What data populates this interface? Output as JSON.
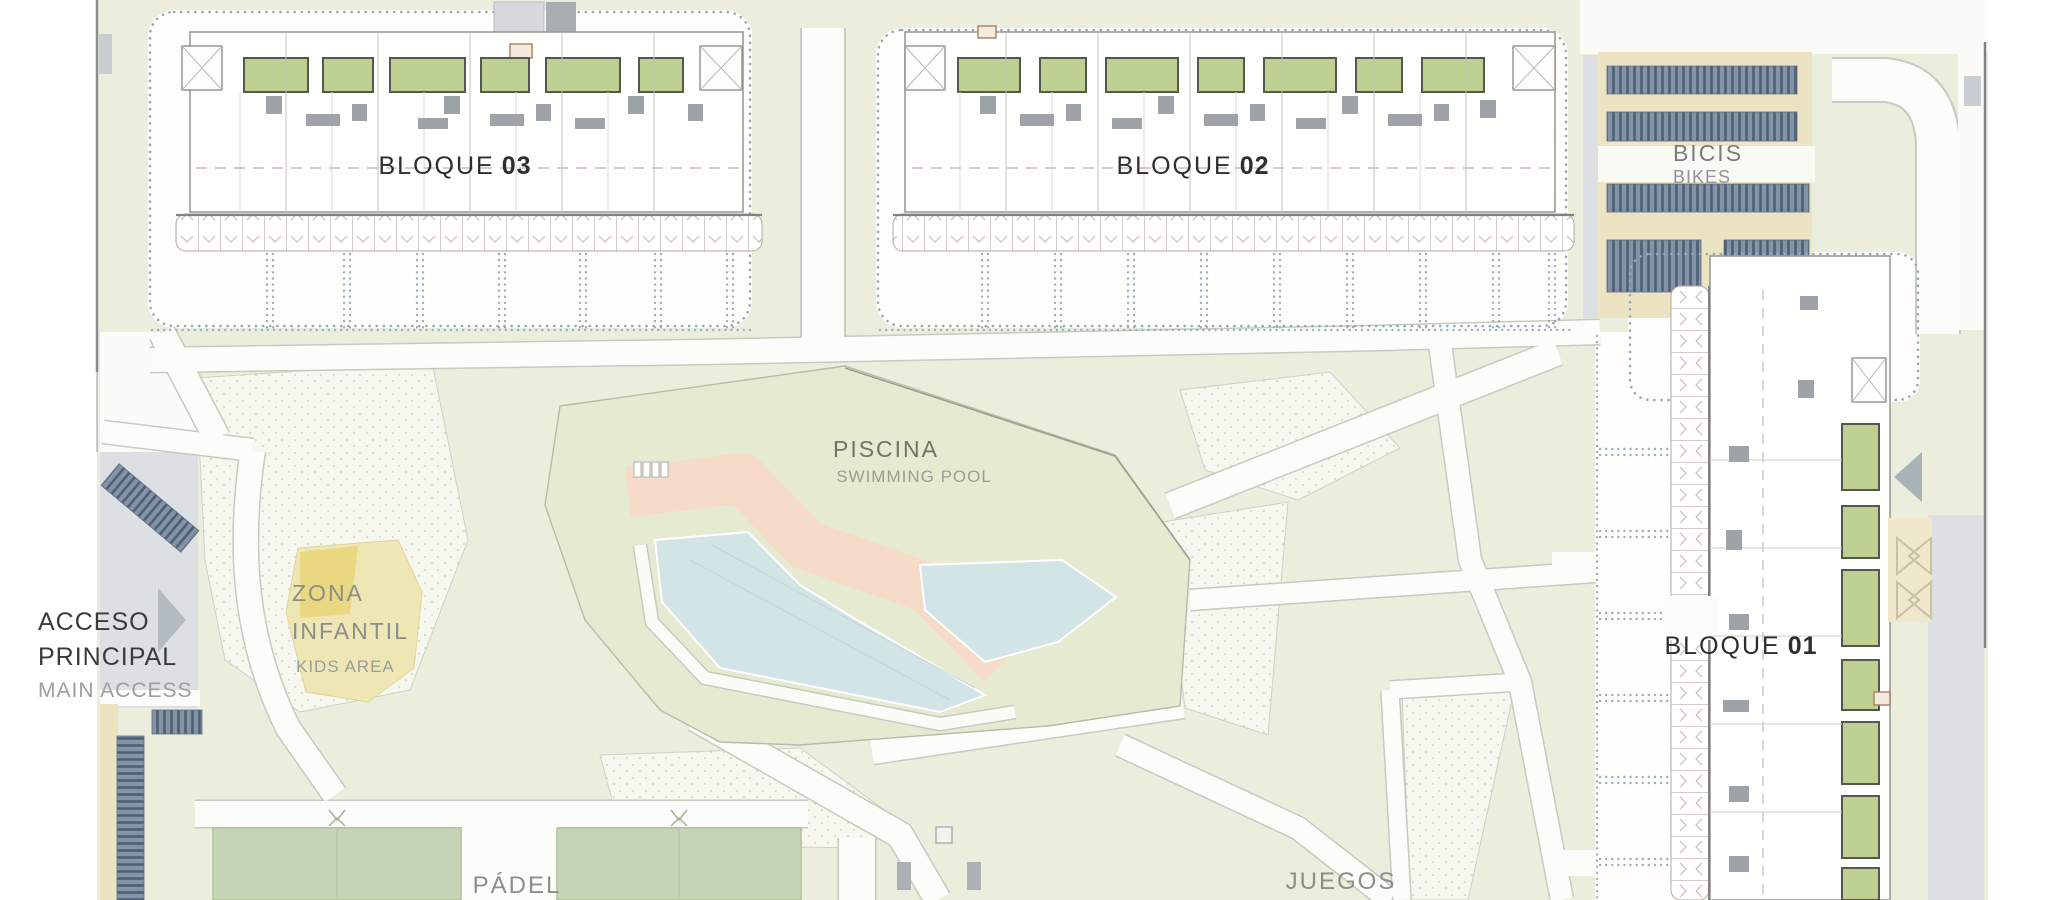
{
  "document": {
    "type": "residential-masterplan-site-plan"
  },
  "labels": {
    "bloque03": {
      "name": "BLOQUE",
      "number": "03"
    },
    "bloque02": {
      "name": "BLOQUE",
      "number": "02"
    },
    "bloque01": {
      "name": "BLOQUE",
      "number": "01"
    },
    "bikes": {
      "es": "BICIS",
      "en": "BIKES"
    },
    "pool": {
      "es": "PISCINA",
      "en": "SWIMMING POOL"
    },
    "kids": {
      "es_line1": "ZONA",
      "es_line2": "INFANTIL",
      "en": "KIDS AREA"
    },
    "access": {
      "es_line1": "ACCESO",
      "es_line2": "PRINCIPAL",
      "en": "MAIN ACCESS"
    },
    "padel": {
      "es": "PÁDEL"
    },
    "games": {
      "es": "JUEGOS"
    }
  },
  "colors": {
    "site_green": "#ebeedc",
    "pool_platform_green": "#e6ead0",
    "path_white": "#fcfdfa",
    "path_edge": "#c6cac0",
    "pool_water": "#d3e4e6",
    "pool_deck_salmon": "#f5dbc8",
    "padel_court_green": "#c6d5b4",
    "patio_green": "#bdd092",
    "kids_yellow": "#efe6b6",
    "kids_yellow_bright": "#e8d67a",
    "bike_area_beige": "#ebe3c1",
    "bike_rack_slate": "#8494a5",
    "bike_rack_dark": "#4d5f75",
    "road_gray": "#dce0e2",
    "building_outline": "#9b9b97",
    "courtyard_dot_blue": "#96a9b8",
    "text_dark": "#2e2e2e",
    "text_gray_green": "#8a8f88",
    "text_light_gray": "#989e97"
  }
}
